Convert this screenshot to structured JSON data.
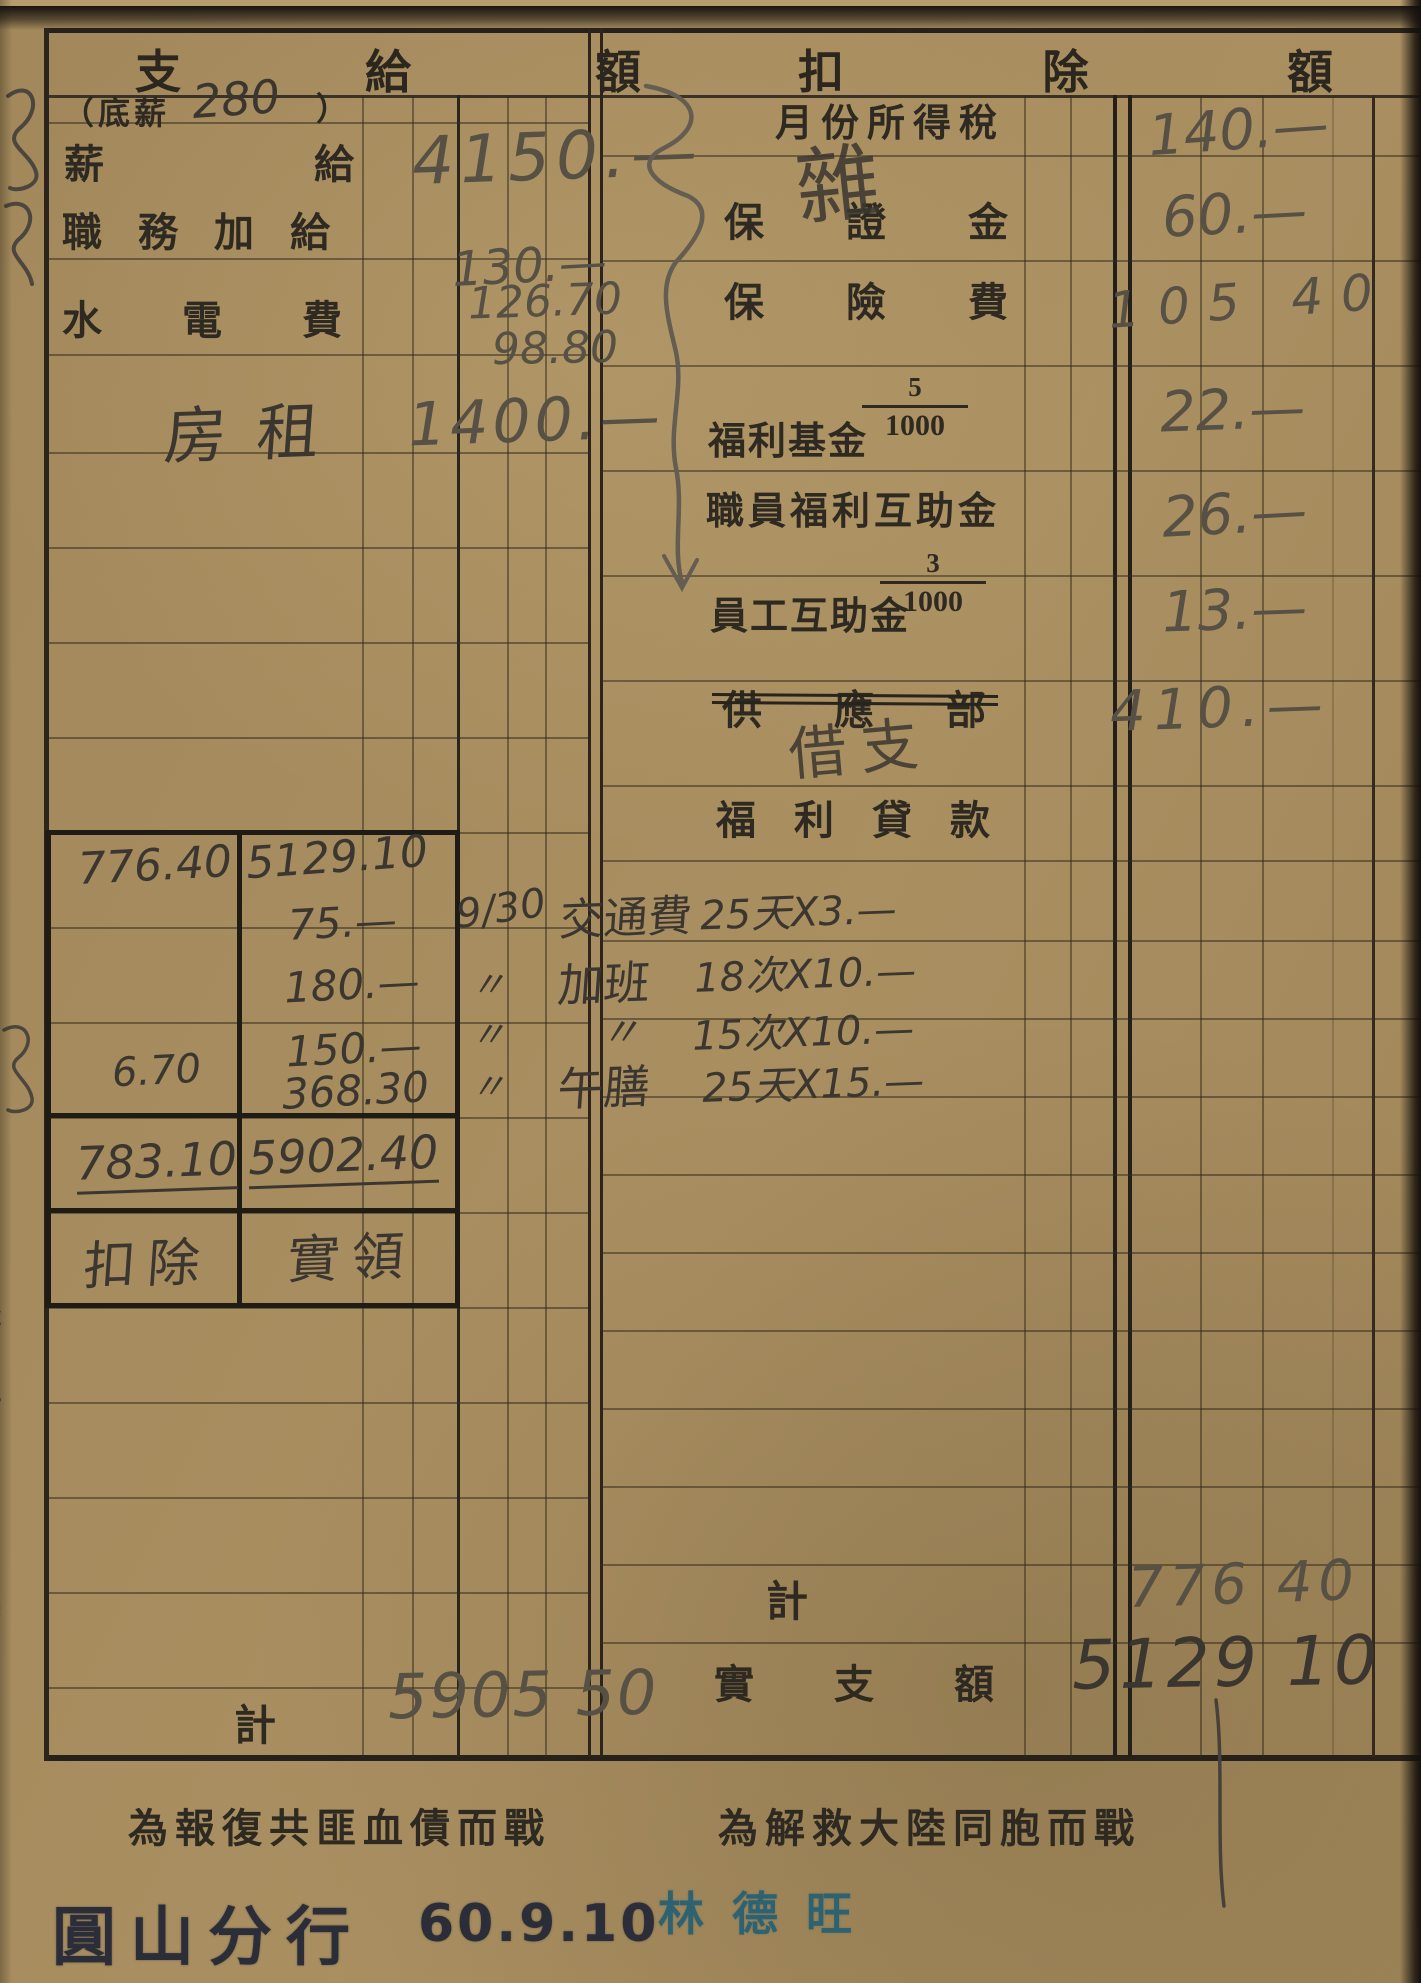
{
  "colors": {
    "paper": "#a78d5f",
    "printed_ink": "#2e2a22",
    "pencil": "#575045",
    "dark_pencil": "#3b3630",
    "branch_stamp_ink": "#2b2e38",
    "signature_stamp_ink": "#2f6270"
  },
  "pay_section": {
    "header": [
      "支",
      "給",
      "額"
    ],
    "base_note": {
      "prefix": "（底薪",
      "amount": "280",
      "suffix": "）"
    },
    "rows": [
      {
        "label": "薪給",
        "value": "4150.—"
      },
      {
        "label": "職務加給",
        "value": "130.—"
      },
      {
        "label": "水電費",
        "value1": "126.70",
        "value2": "98.80"
      },
      {
        "label": "房租",
        "value": "1400.—"
      }
    ],
    "total_label": "計",
    "total_value": "5905 50"
  },
  "deduction_section": {
    "header": [
      "扣",
      "除",
      "額"
    ],
    "rows": [
      {
        "label": "月份所得稅",
        "note": "雜",
        "value": "140.—"
      },
      {
        "label": "保證金",
        "value": "60.—"
      },
      {
        "label": "保險費",
        "value": "105 40"
      },
      {
        "label": "福利基金",
        "fraction_num": "5",
        "fraction_den": "1000",
        "value": "22.—"
      },
      {
        "label": "職員福利互助金",
        "value": "26.—"
      },
      {
        "label": "員工互助金",
        "fraction_num": "3",
        "fraction_den": "1000",
        "value": "13.—"
      },
      {
        "label": "供應部",
        "note": "借支",
        "value": "410.—"
      },
      {
        "label": "福利貸款",
        "value": ""
      }
    ],
    "total_label": "計",
    "total_value": "776 40",
    "net_label": "實支額",
    "net_value": "5129 10"
  },
  "calc_box": {
    "col1": [
      "776.40",
      "6.70",
      "783.10",
      "扣除"
    ],
    "col2": [
      "5129.10",
      "75.—",
      "180.—",
      "150.—",
      "368.30",
      "5902.40",
      "實領"
    ],
    "annotations": [
      {
        "date": "9/30",
        "item": "交通費",
        "formula": "25天X3.—"
      },
      {
        "date": "〃",
        "item": "加班",
        "formula": "18次X10.—"
      },
      {
        "date": "〃",
        "item": "〃",
        "formula": "15次X10.—"
      },
      {
        "date": "〃",
        "item": "午膳",
        "formula": "25天X15.—"
      }
    ]
  },
  "footer": {
    "slogan_left": "為報復共匪血債而戰",
    "slogan_right": "為解救大陸同胞而戰",
    "branch_stamp": "圓山分行",
    "date_stamp": "60.9.10",
    "signature_stamp": "林德旺",
    "margin_print": "總106號 60. 4. 30,000(北)"
  }
}
